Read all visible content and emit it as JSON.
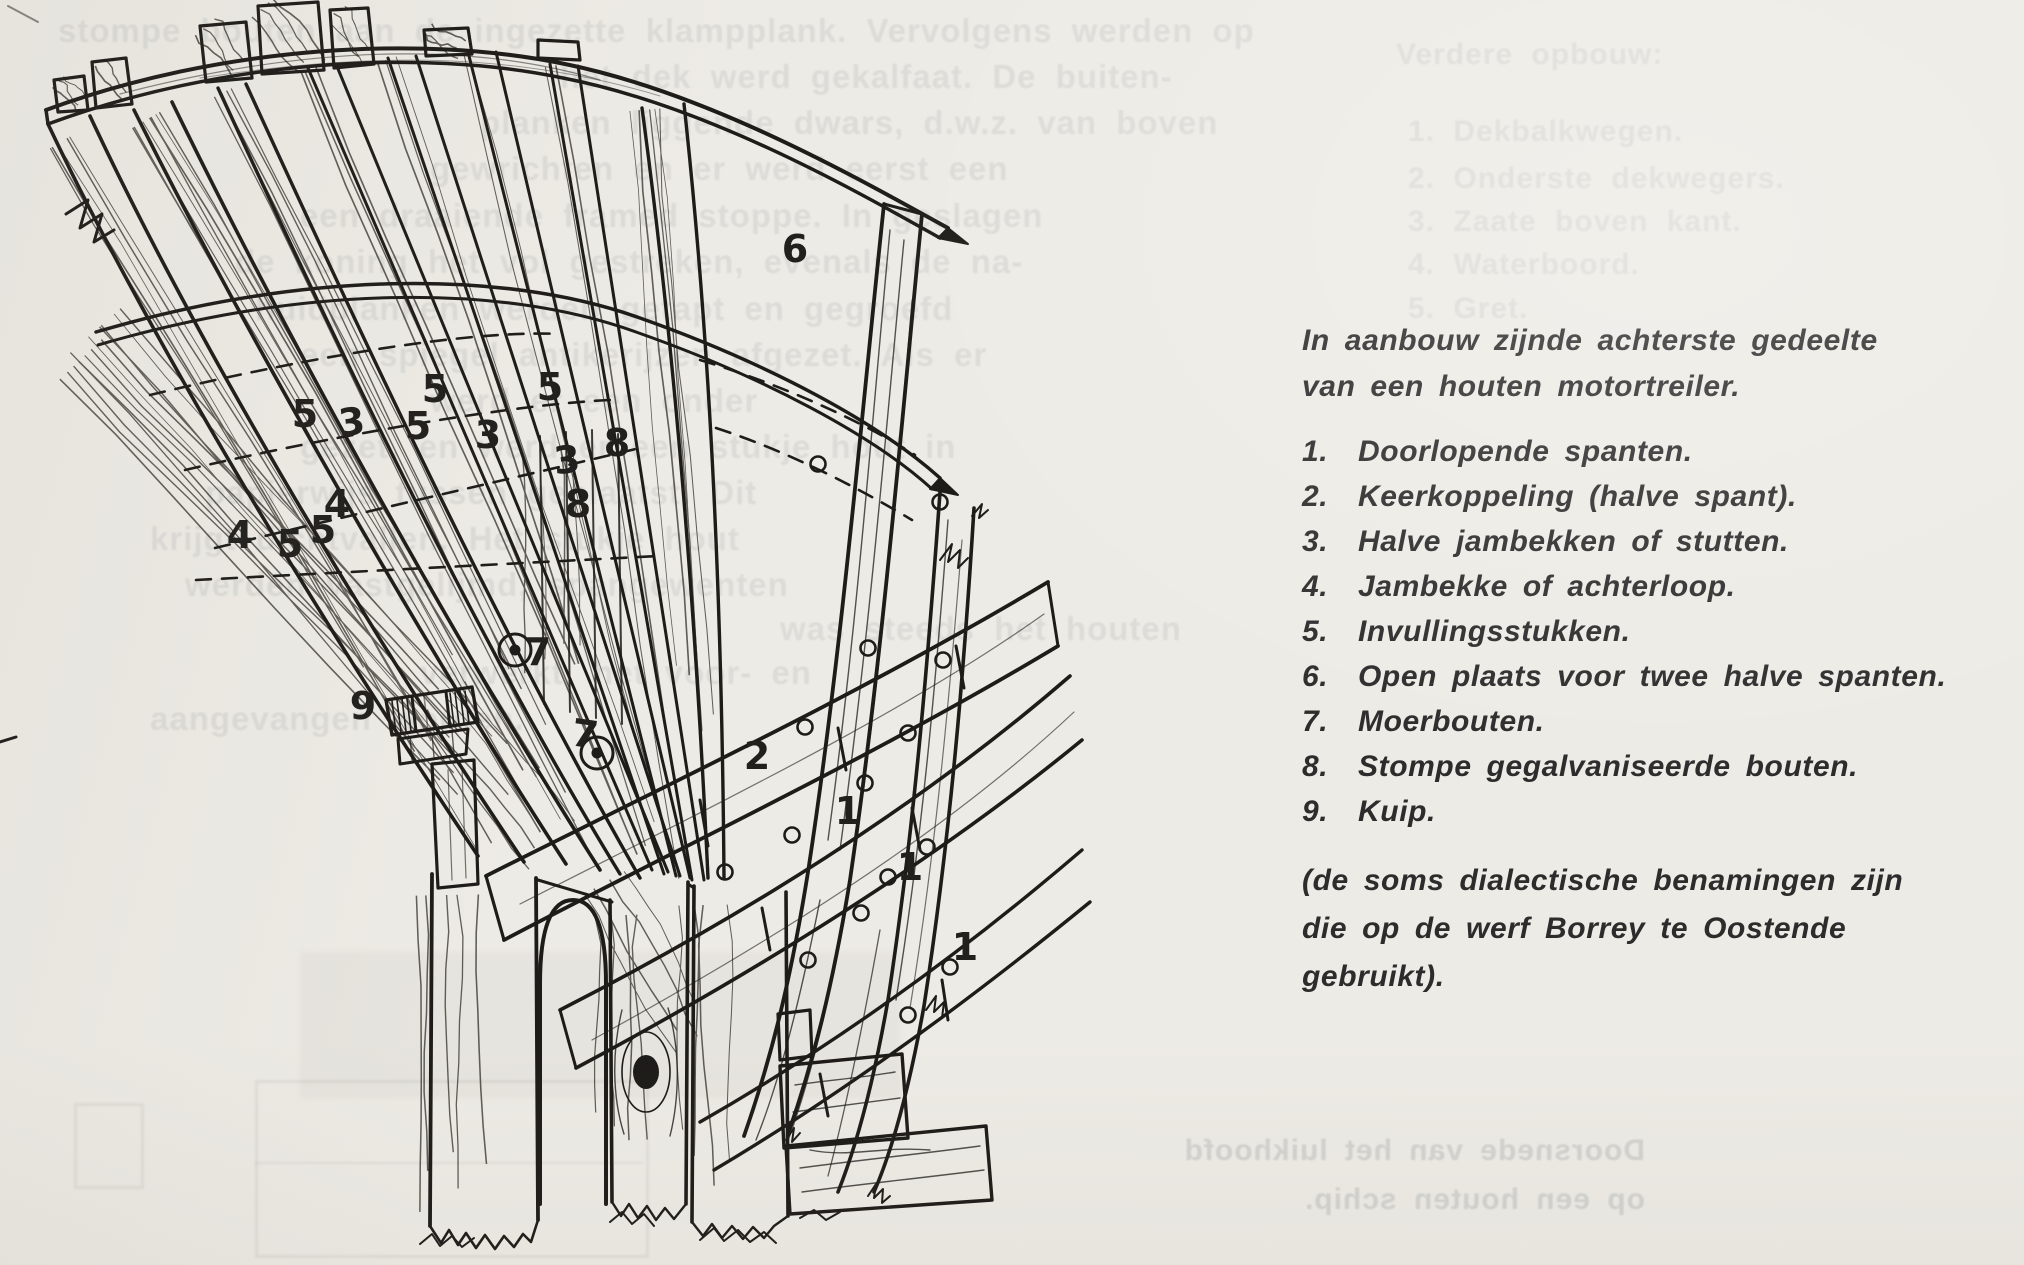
{
  "page": {
    "paper_color": "#edebe5",
    "ink_color": "#1e1c19",
    "caption_text_color": "#2c2c2c"
  },
  "figure_caption": {
    "title_lines": [
      "In aanbouw zijnde achterste gedeelte",
      "van een houten motortreiler."
    ],
    "items": [
      {
        "num": "1.",
        "text": "Doorlopende spanten."
      },
      {
        "num": "2.",
        "text": "Keerkoppeling (halve spant)."
      },
      {
        "num": "3.",
        "text": "Halve jambekken of stutten."
      },
      {
        "num": "4.",
        "text": "Jambekke of achterloop."
      },
      {
        "num": "5.",
        "text": "Invullingsstukken."
      },
      {
        "num": "6.",
        "text": "Open plaats voor twee halve spanten."
      },
      {
        "num": "7.",
        "text": "Moerbouten."
      },
      {
        "num": "8.",
        "text": "Stompe gegalvaniseerde bouten."
      },
      {
        "num": "9.",
        "text": "Kuip."
      }
    ],
    "note_lines": [
      "(de soms dialectische benamingen zijn",
      "die op de werf Borrey te Oostende",
      "gebruikt)."
    ]
  },
  "drawing": {
    "labels": [
      "6",
      "5",
      "5",
      "5",
      "3",
      "5",
      "3",
      "8",
      "3",
      "4",
      "8",
      "5",
      "4",
      "5",
      "7",
      "9",
      "7",
      "2",
      "1",
      "1",
      "1"
    ]
  },
  "ghost_text": {
    "paragraph_fragments": [
      "stompe bouten aan de ingezette klampplank. Vervolgens werden op",
      "het dek werd gekalfaat. De buiten-",
      "planken liggende dwars, d.w.z. van boven",
      "gewrichten en er werd eerst een",
      "een draaiende framed stoppe. In geslagen",
      "de koning het vol gestreken, evenals de na-",
      "huidplanken werden getapt en gegroefd",
      "een spiegel antikerijzen afgezet. Als er",
      "werd er een onder",
      "gezet, en werd er een stukje hout in",
      "papierwijs tussen geplaatst. Dit",
      "krijgt dichtvallen. Het stukje hout",
      "werden vastgelijmd, spangewenten",
      "was steeds het houten",
      "verwerkt, het voor- en",
      "aangevangen worden."
    ],
    "column_lines": [
      "Verdere opbouw:",
      "1. Dekbalkwegen.",
      "2. Onderste dekwegers.",
      "3. Zaate boven kant.",
      "4. Waterboord.",
      "5. Gret."
    ],
    "mirrored_caption_lines": [
      "Doorsnede van het luikhoofd",
      "op een houten schip."
    ]
  }
}
